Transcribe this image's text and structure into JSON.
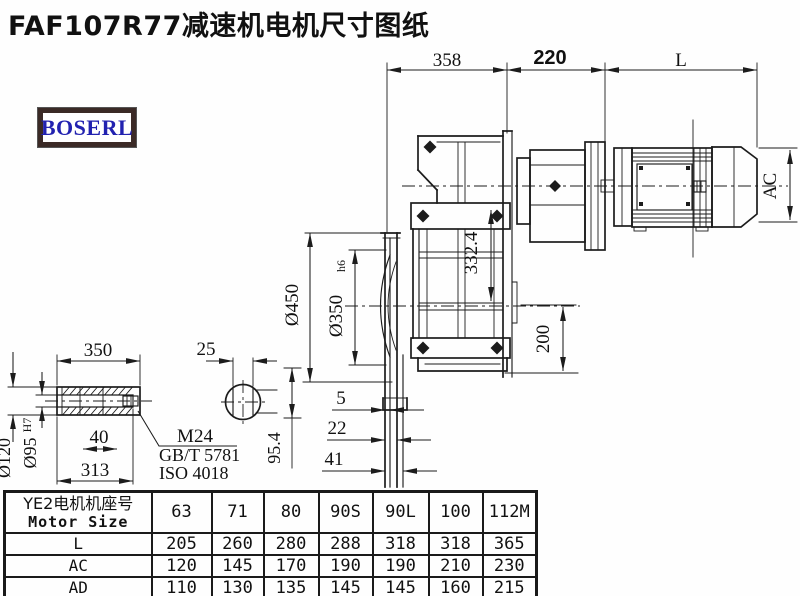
{
  "title": "FAF107R77减速机电机尺寸图纸",
  "logo": {
    "text": "BOSERL"
  },
  "dimensions": {
    "top": {
      "d358": "358",
      "d220": "220",
      "dL": "L"
    },
    "motor": {
      "ac": "AC"
    },
    "gearbox": {
      "d332": "332.4",
      "d200": "200"
    },
    "flange": {
      "d450": "Ø450",
      "d350": "Ø350",
      "d350_tol": "h6",
      "d95_4": "95.4",
      "d5": "5",
      "d22": "22",
      "d41": "41"
    },
    "shaft": {
      "len": "350",
      "d25": "25",
      "d120": "Ø120",
      "d95": "Ø95",
      "d95_tol": "H7",
      "d40": "40",
      "d313": "313",
      "bolt": "M24",
      "std1": "GB/T 5781",
      "std2": "ISO 4018"
    }
  },
  "table": {
    "header_cn": "YE2电机机座号",
    "header_en": "Motor Size",
    "columns": [
      "63",
      "71",
      "80",
      "90S",
      "90L",
      "100",
      "112M"
    ],
    "rows": [
      {
        "label": "L",
        "values": [
          "205",
          "260",
          "280",
          "288",
          "318",
          "318",
          "365"
        ]
      },
      {
        "label": "AC",
        "values": [
          "120",
          "145",
          "170",
          "190",
          "190",
          "210",
          "230"
        ]
      },
      {
        "label": "AD",
        "values": [
          "110",
          "130",
          "135",
          "145",
          "145",
          "160",
          "215"
        ]
      }
    ]
  }
}
